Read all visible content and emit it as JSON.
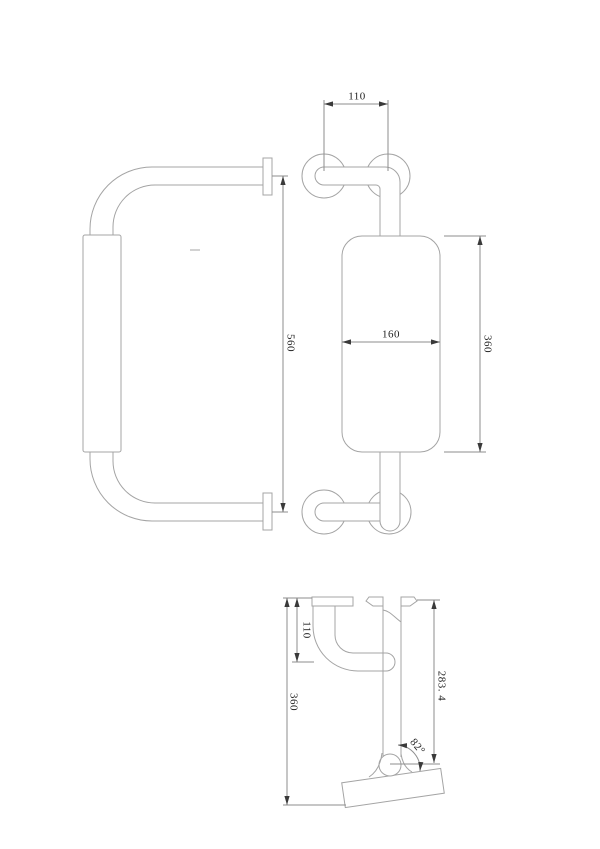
{
  "drawing": {
    "title": "grab-bar-with-backrest-technical-drawing",
    "colors": {
      "geometry": "#a4a4a4",
      "dimension": "#8e8e8e",
      "arrow": "#3a3a3a",
      "text": "#1f1f1f",
      "background": "#ffffff"
    },
    "views": {
      "side_view": {
        "dim_overall_height": "560"
      },
      "front_view": {
        "dim_flange_spacing": "110",
        "dim_pad_width": "160",
        "dim_pad_height": "360"
      },
      "profile_view": {
        "dim_wall_offset": "110",
        "dim_overall_depth": "360",
        "dim_drop": "283. 4",
        "dim_angle": "82°"
      }
    }
  }
}
